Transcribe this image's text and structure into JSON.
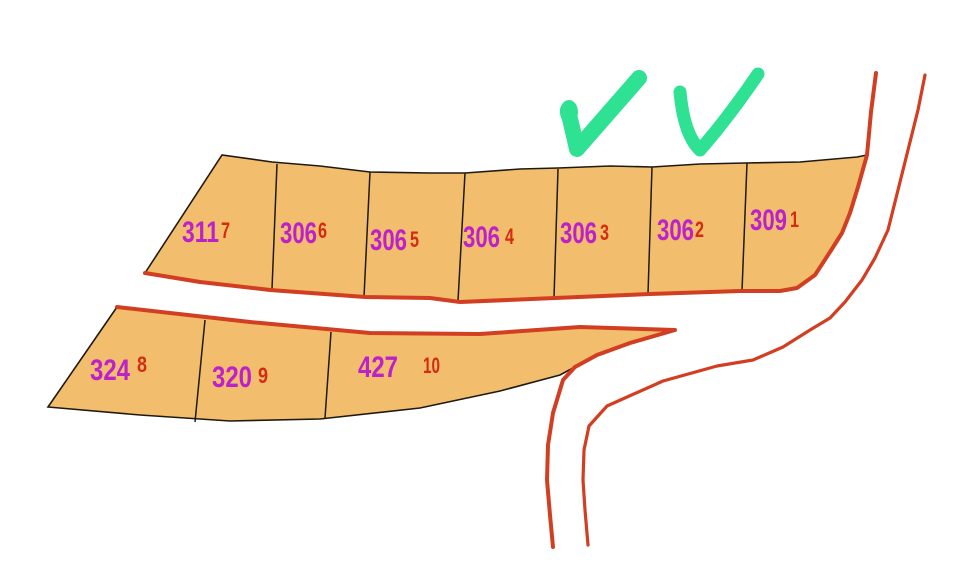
{
  "map": {
    "name": "cadastral-parcel-map",
    "parcels": {
      "top": [
        {
          "number": "311",
          "sub": "7"
        },
        {
          "number": "306",
          "sub": "6"
        },
        {
          "number": "306",
          "sub": "5"
        },
        {
          "number": "306",
          "sub": "4"
        },
        {
          "number": "306",
          "sub": "3"
        },
        {
          "number": "306",
          "sub": "2"
        },
        {
          "number": "309",
          "sub": "1"
        }
      ],
      "bottom": [
        {
          "number": "324",
          "sub": "8"
        },
        {
          "number": "320",
          "sub": "9"
        },
        {
          "number": "427",
          "sub": "10"
        }
      ]
    },
    "annotations": {
      "checkmarks": [
        {
          "icon": "checkmark-icon"
        },
        {
          "icon": "checkmark-icon"
        }
      ]
    }
  },
  "colors": {
    "background": "#FFFFFF",
    "parcel_fill": "#F2BD6C",
    "boundary_black": "#1F1A10",
    "road_red": "#D23E21",
    "parcel_number_purple": "#BB22CC",
    "sub_number_red": "#D42B12",
    "checkmark_green": "#2EE193"
  }
}
